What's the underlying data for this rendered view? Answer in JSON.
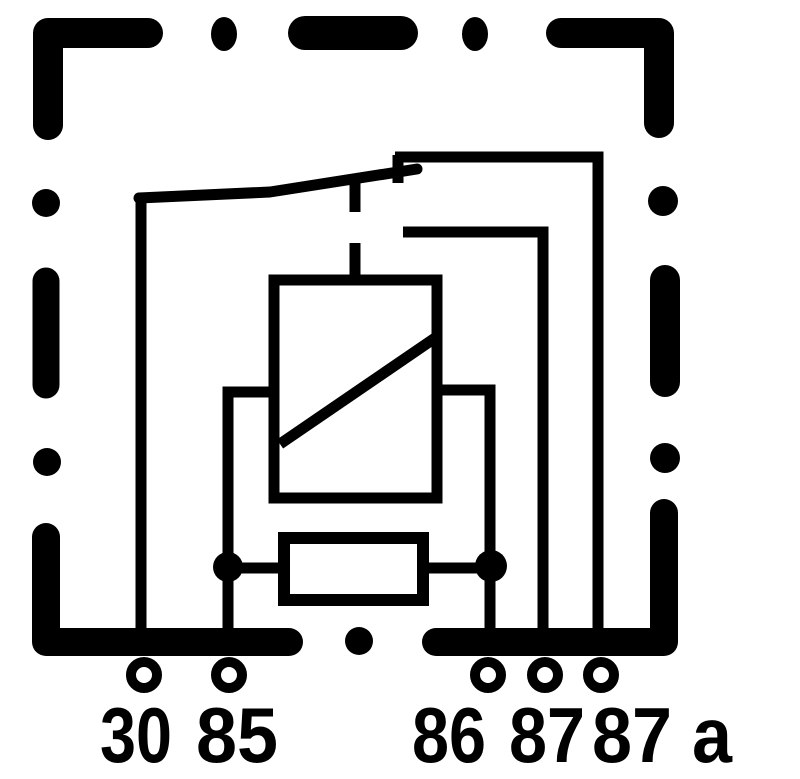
{
  "colors": {
    "background": "#ffffff",
    "ink": "#000000"
  },
  "terminals": [
    {
      "label": "30"
    },
    {
      "label": "85"
    },
    {
      "label": "86"
    },
    {
      "label": "87"
    },
    {
      "label": "87 a"
    }
  ]
}
